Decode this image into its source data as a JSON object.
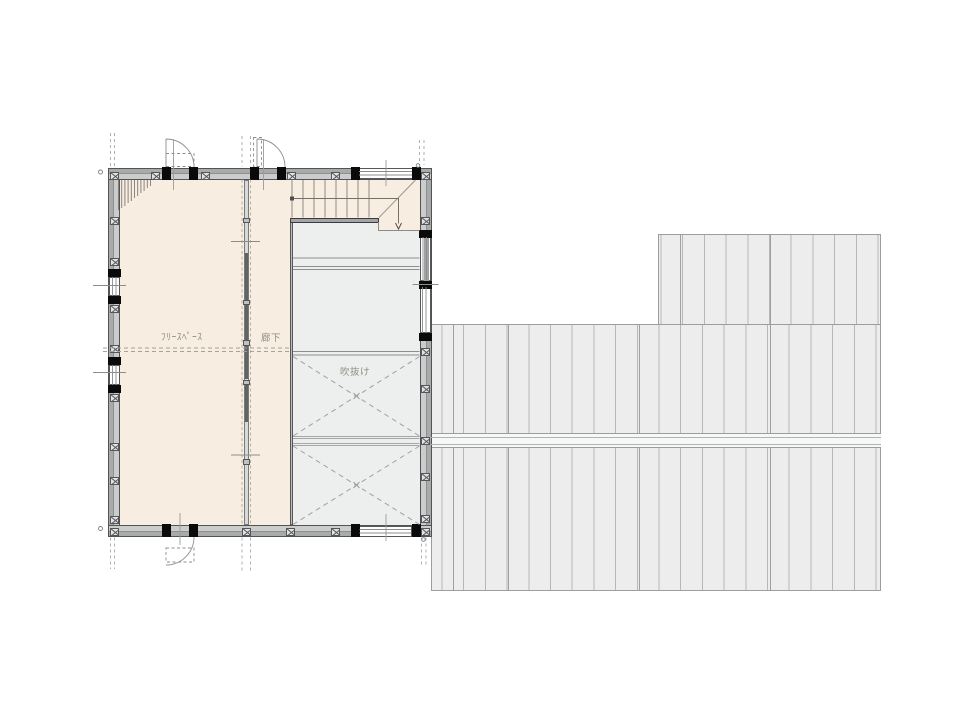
{
  "drawing": {
    "type": "architectural-floor-plan",
    "rooms": [
      {
        "id": "free-space",
        "label": "ﾌﾘｰｽﾍﾟｰｽ"
      },
      {
        "id": "corridor",
        "label": "廊下"
      },
      {
        "id": "void",
        "label": "吹抜け"
      }
    ],
    "stair": {
      "direction_symbol": "down-arrow"
    }
  },
  "icons": [
    {
      "name": "post-symbol",
      "meaning": "structural post (crossed square)"
    },
    {
      "name": "pillar-black",
      "meaning": "load-bearing pillar (solid black)"
    },
    {
      "name": "door-swing-arc",
      "meaning": "door swing direction"
    },
    {
      "name": "stair-down-arrow",
      "meaning": "stair descends"
    }
  ],
  "colors": {
    "background": "#ffffff",
    "room_fill": "#f7ede1",
    "void_fill": "#ecefed",
    "roof_fill": "#ededee",
    "roof_line": "#b5b8b8",
    "wall_fill": "#cbcccc",
    "wall_outline": "#515357",
    "pillar_black": "#0a0a0a",
    "drawing_line": "#8b8d8d",
    "label_text": "#8f8e86"
  }
}
